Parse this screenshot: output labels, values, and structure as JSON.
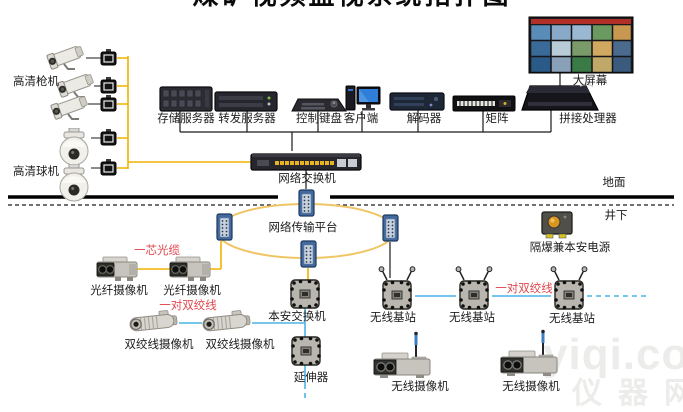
{
  "title": "煤矿视频监视系统拓扑图",
  "zones": {
    "surface": "地面",
    "underground": "井下"
  },
  "devices": {
    "hd_bullet": "高清枪机",
    "hd_dome": "高清球机",
    "storage": "存储服务器",
    "forward": "转发服务器",
    "keyboard": "控制键盘",
    "client": "客户端",
    "decoder": "解码器",
    "matrix": "矩阵",
    "splicer": "拼接处理器",
    "big_screen": "大屏幕",
    "net_switch": "网络交换机",
    "ring_platform": "网络传输平台",
    "power": "隔爆兼本安电源",
    "fiber_cam": "光纤摄像机",
    "tp_cam": "双绞线摄像机",
    "safe_switch": "本安交换机",
    "extender": "延伸器",
    "base_station": "无线基站",
    "wireless_cam": "无线摄像机"
  },
  "cables": {
    "fiber": "一芯光缆",
    "twisted_pair": "一对双绞线"
  },
  "watermark": {
    "line1": "yiqi.com",
    "line2": "仪器网"
  },
  "colors": {
    "yellow": "#f0b400",
    "cyan": "#4ab4e6",
    "ring_ellipse": "#f0c565",
    "red_label": "#e0474e",
    "ground": "#000000"
  }
}
